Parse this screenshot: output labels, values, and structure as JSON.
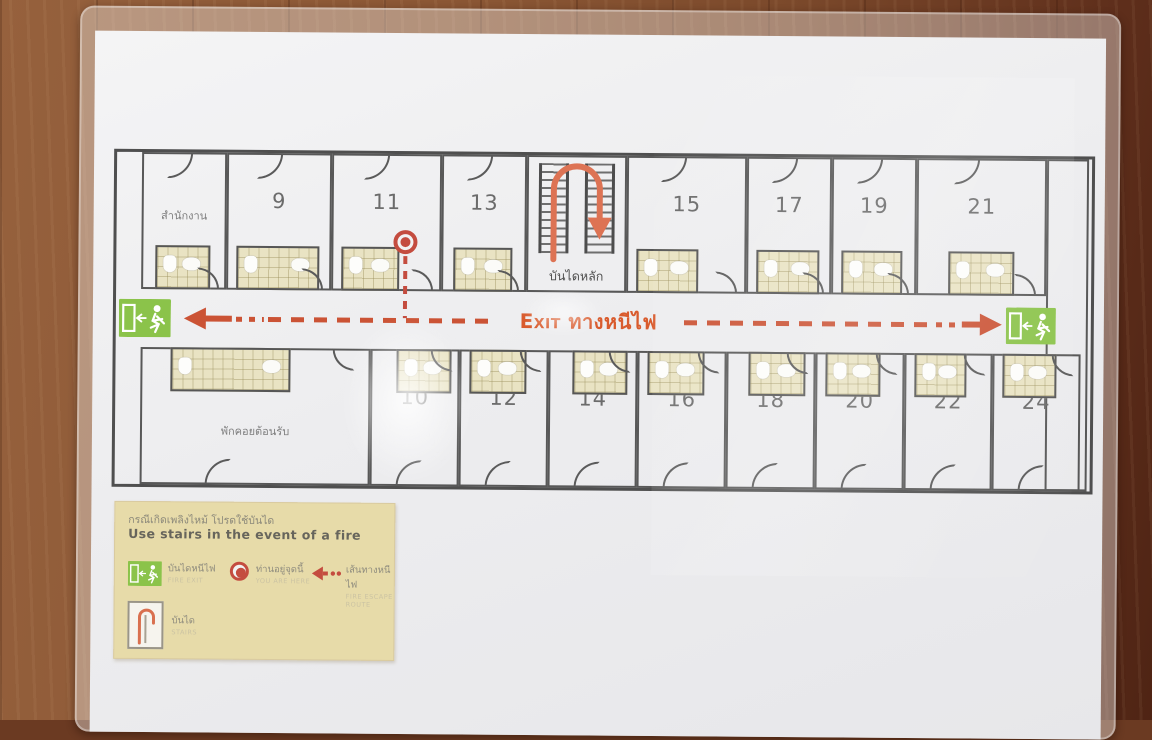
{
  "plan": {
    "exit_text": "Exit ทางหนีไฟ",
    "stairs_label": "บันไดหลัก",
    "top_rooms": [
      "สำนักงาน",
      "9",
      "11",
      "13",
      "15",
      "17",
      "19",
      "21"
    ],
    "bottom_rooms": [
      "พักคอยต้อนรับ",
      "10",
      "12",
      "14",
      "16",
      "18",
      "20",
      "22",
      "24"
    ]
  },
  "legend": {
    "title_th": "กรณีเกิดเพลิงไหม้ โปรดใช้บันได",
    "title_en": "Use  stairs  in  the  event  of  a  fire",
    "items": [
      {
        "icon": "exit-sign-icon",
        "label": "บันไดหนีไฟ",
        "sub": "FIRE EXIT"
      },
      {
        "icon": "you-are-here-dot-icon",
        "label": "ท่านอยู่จุดนี้",
        "sub": "YOU ARE HERE"
      },
      {
        "icon": "escape-route-arrow-icon",
        "label": "เส้นทางหนีไฟ",
        "sub": "FIRE ESCAPE ROUTE"
      },
      {
        "icon": "stairs-icon",
        "label": "บันได",
        "sub": "STAIRS"
      }
    ]
  },
  "colors": {
    "route_red": "#cb5335",
    "exit_text_orange": "#d95b2d",
    "exit_sign_green": "#8bc34a",
    "legend_background": "#e7dba9",
    "bathroom_tan": "#e9e3c3"
  }
}
